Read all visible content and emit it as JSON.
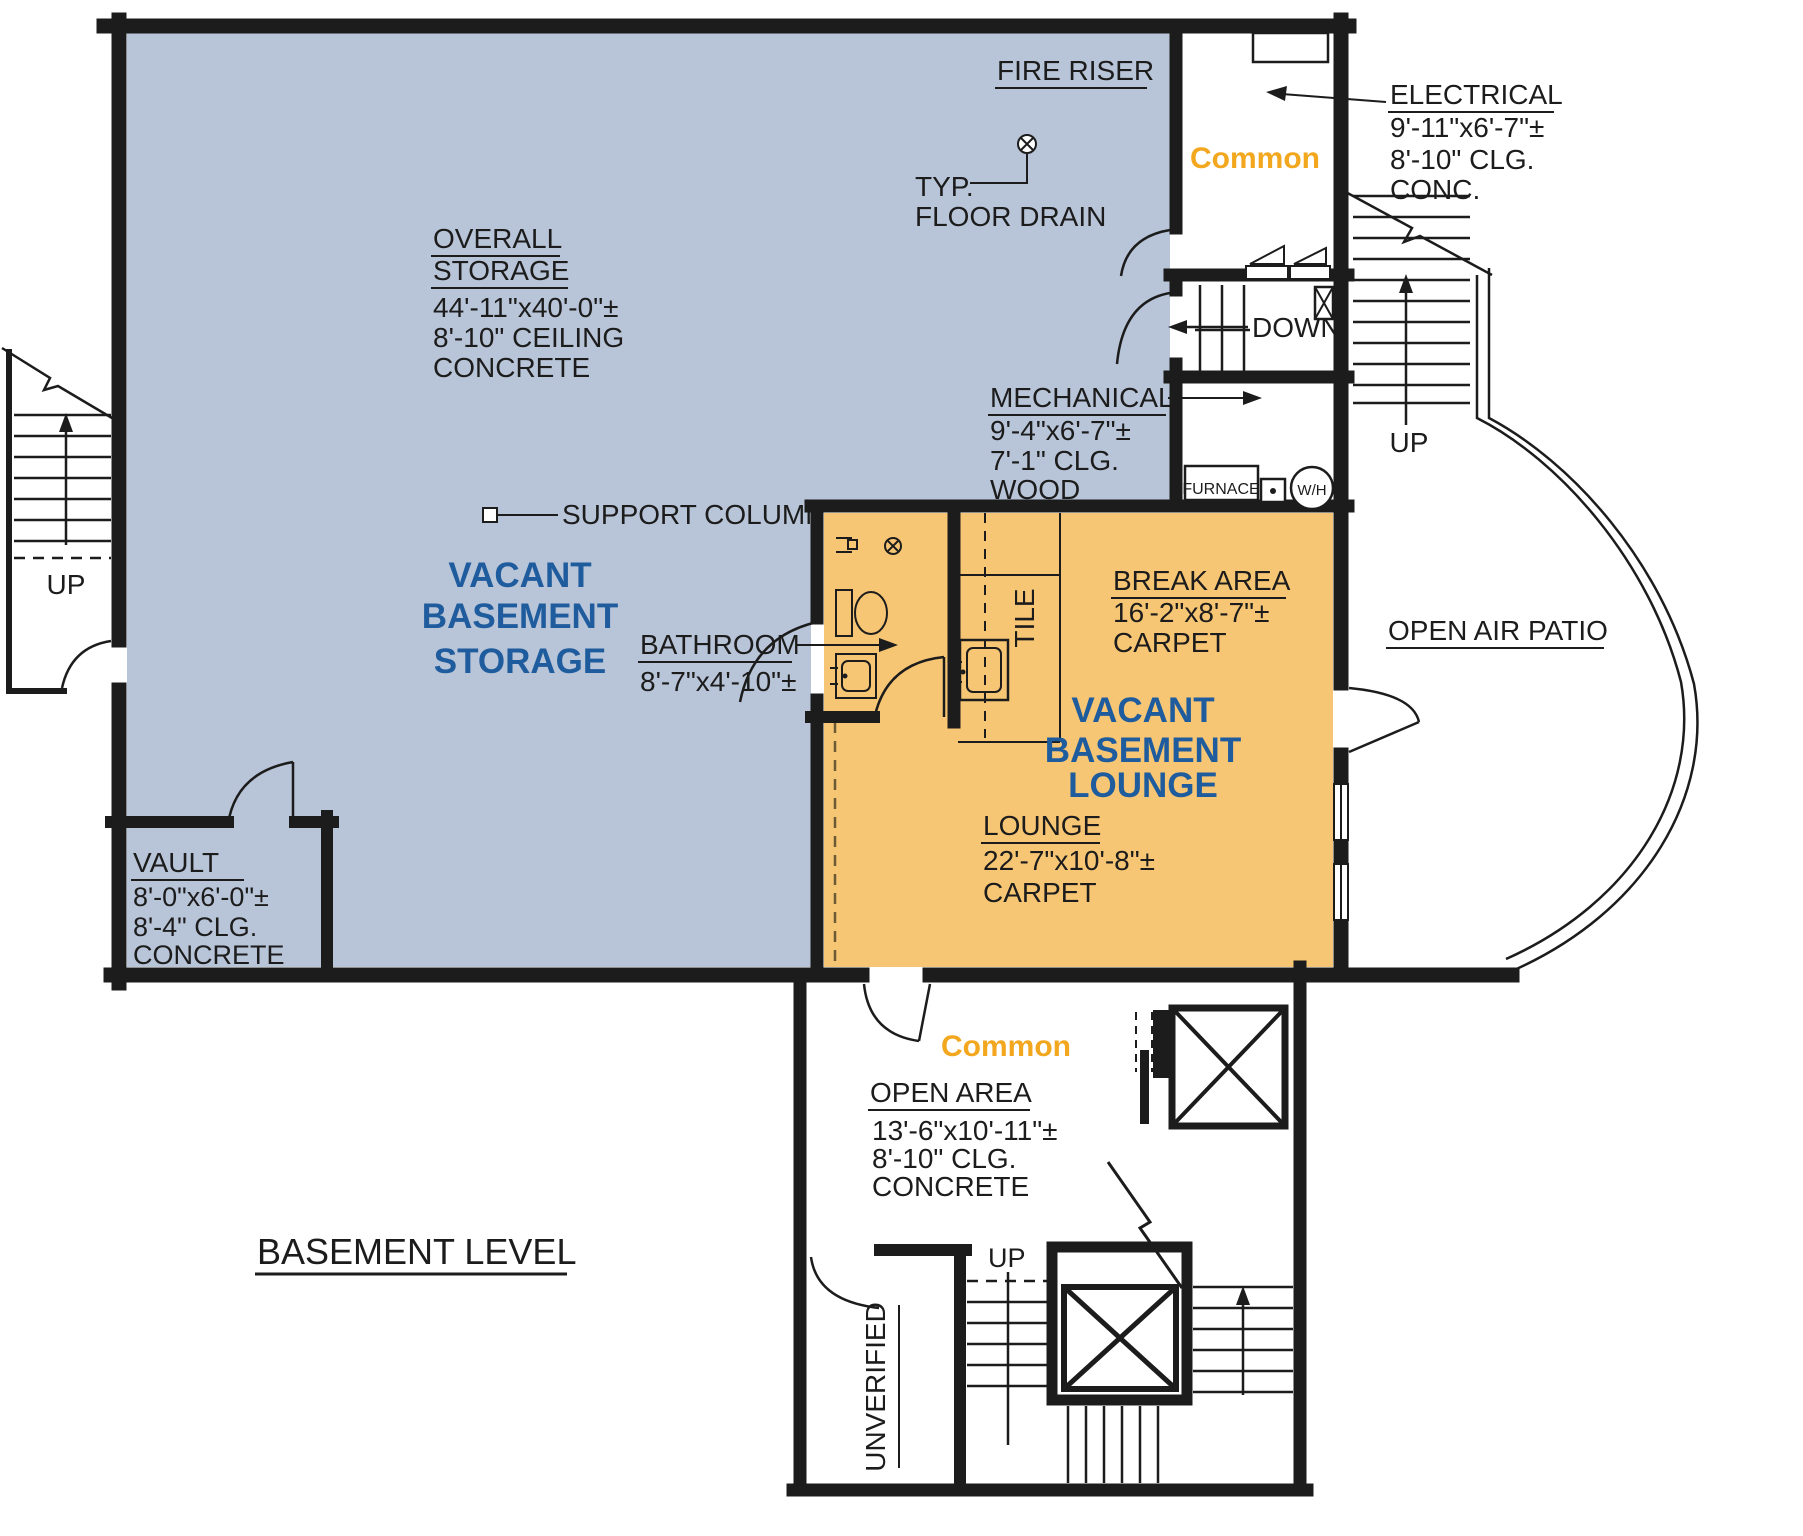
{
  "title": "BASEMENT LEVEL",
  "colors": {
    "storage_fill": "#b8c4d7",
    "lounge_fill": "#f7c674",
    "accent_blue": "#1f5c9e",
    "accent_orange": "#f2a71e",
    "line": "#1c1c1c"
  },
  "rooms": {
    "overall_storage": {
      "label_line1": "OVERALL",
      "label_line2": "STORAGE",
      "dim": "44'-11\"x40'-0\"±",
      "ceiling": "8'-10\" CEILING",
      "floor": "CONCRETE"
    },
    "vacant_storage": {
      "line1": "VACANT",
      "line2": "BASEMENT",
      "line3": "STORAGE"
    },
    "fire_riser": {
      "label": "FIRE RISER"
    },
    "electrical": {
      "label": "ELECTRICAL",
      "dim": "9'-11\"x6'-7\"±",
      "ceiling": "8'-10\" CLG.",
      "floor": "CONC."
    },
    "mechanical": {
      "label": "MECHANICAL",
      "dim": "9'-4\"x6'-7\"±",
      "ceiling": "7'-1\" CLG.",
      "floor": "WOOD"
    },
    "common_upper": {
      "label": "Common"
    },
    "common_lower": {
      "label": "Common"
    },
    "bathroom": {
      "label": "BATHROOM",
      "dim": "8'-7\"x4'-10\"±"
    },
    "kitchenette": {
      "floor": "TILE"
    },
    "break_area": {
      "label": "BREAK AREA",
      "dim": "16'-2\"x8'-7\"±",
      "floor": "CARPET"
    },
    "vacant_lounge": {
      "line1": "VACANT",
      "line2": "BASEMENT",
      "line3": "LOUNGE"
    },
    "lounge": {
      "label": "LOUNGE",
      "dim": "22'-7\"x10'-8\"±",
      "floor": "CARPET"
    },
    "open_air_patio": {
      "label": "OPEN AIR PATIO"
    },
    "vault": {
      "label": "VAULT",
      "dim": "8'-0\"x6'-0\"±",
      "ceiling": "8'-4\" CLG.",
      "floor": "CONCRETE"
    },
    "open_area": {
      "label": "OPEN AREA",
      "dim": "13'-6\"x10'-11\"±",
      "ceiling": "8'-10\" CLG.",
      "floor": "CONCRETE"
    },
    "unverified": {
      "label": "UNVERIFIED"
    }
  },
  "annotations": {
    "floor_drain_line1": "TYP.",
    "floor_drain_line2": "FLOOR DRAIN",
    "support_column": "SUPPORT COLUMN"
  },
  "equipment": {
    "furnace": "FURNACE",
    "water_heater": "W/H"
  },
  "stairs": {
    "up_label": "UP",
    "down_label": "DOWN"
  }
}
